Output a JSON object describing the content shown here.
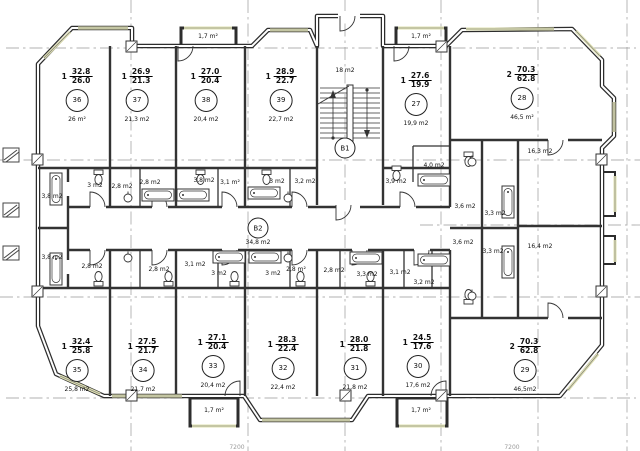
{
  "stairwell": {
    "id": "B1",
    "area": "18 m2"
  },
  "corridor": {
    "id": "B2",
    "area": "34,8 m2"
  },
  "balconies": [
    "1,7 m²",
    "1,7 m²",
    "1,7 m²",
    "1,7 m²"
  ],
  "apartments": [
    {
      "id": "36",
      "rooms": "1",
      "total": "32.8",
      "living": "26.0",
      "area": "26 m²"
    },
    {
      "id": "37",
      "rooms": "1",
      "total": "26.9",
      "living": "21.3",
      "area": "21,3 m2"
    },
    {
      "id": "38",
      "rooms": "1",
      "total": "27.0",
      "living": "20.4",
      "area": "20,4 m2"
    },
    {
      "id": "39",
      "rooms": "1",
      "total": "28.9",
      "living": "22.7",
      "area": "22,7 m2"
    },
    {
      "id": "27",
      "rooms": "1",
      "total": "27.6",
      "living": "19.9",
      "area": "19,9 m2"
    },
    {
      "id": "28",
      "rooms": "2",
      "total": "70.3",
      "living": "62.8",
      "area": "46,5 m²"
    },
    {
      "id": "35",
      "rooms": "1",
      "total": "32.4",
      "living": "25.8",
      "area": "25,8 m2"
    },
    {
      "id": "34",
      "rooms": "1",
      "total": "27.5",
      "living": "21.7",
      "area": "21,7 m2"
    },
    {
      "id": "33",
      "rooms": "1",
      "total": "27.1",
      "living": "20.4",
      "area": "20,4 m2"
    },
    {
      "id": "32",
      "rooms": "1",
      "total": "28.3",
      "living": "22.4",
      "area": "22,4 m2"
    },
    {
      "id": "31",
      "rooms": "1",
      "total": "28.0",
      "living": "21.8",
      "area": "21,8 m2"
    },
    {
      "id": "30",
      "rooms": "1",
      "total": "24.5",
      "living": "17.6",
      "area": "17,6 m2"
    },
    {
      "id": "29",
      "rooms": "2",
      "total": "70.3",
      "living": "62.8",
      "area": "46,5m2"
    }
  ],
  "small_rooms": [
    "3,8 m2",
    "3 m2",
    "2,8 m2",
    "2,8 m2",
    "3,8 m2",
    "3,1 m²",
    "3 m2",
    "3,2 m2",
    "3,9 m2",
    "4,0 m2",
    "3,6 m2",
    "3,3 m2",
    "3,8 m2",
    "2,8 m2",
    "2,8 m2",
    "3,1 m2",
    "3 m2",
    "3 m2",
    "2,8 m²",
    "2,8 m2",
    "3,3 m2",
    "3,1 m2",
    "3,2 m2",
    "3,6 m2",
    "3,3 m2",
    "16,3 m2",
    "16,4 m2"
  ],
  "dimensions": [
    "7200",
    "7200"
  ],
  "colors": {
    "wall": "#2d2d2d",
    "axis": "#999999",
    "window": "#dfe0b2"
  }
}
